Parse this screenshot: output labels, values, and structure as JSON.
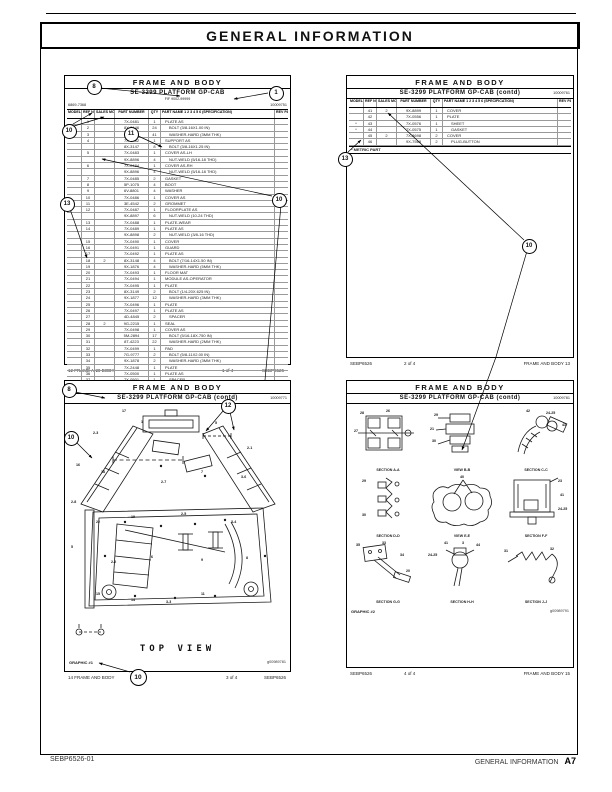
{
  "page": {
    "title": "GENERAL  INFORMATION",
    "footer_left": "SEBP6526-01",
    "footer_right": "GENERAL INFORMATION",
    "footer_page": "A7"
  },
  "callouts": {
    "n1": "1",
    "n8": "8",
    "n10": "10",
    "n11": "11",
    "n12": "12",
    "n13": "13"
  },
  "cols": [
    "MODEL",
    "REF NO",
    "SALES MOD",
    "PART NUMBER",
    "QTY",
    "PART NAME 1 2 3 4 5 6 (SPECIFICATION)",
    "REV PAGE"
  ],
  "panels": {
    "p1": {
      "header": "FRAME AND BODY",
      "subtitle": "SE-3299 PLATFORM GP-CAB",
      "subtitle2": "FIF 9002-99999",
      "code_left": "6869-7368",
      "code_right": "10009751",
      "rows": [
        {
          "r": "1",
          "p": "7X-0481",
          "q": "1",
          "n": "PLATE AS",
          "l": 1
        },
        {
          "r": "2",
          "p": "8X-3146",
          "q": "24",
          "n": "BOLT (3/8-16X1.00 IN)",
          "l": 2
        },
        {
          "r": "3",
          "p": "9X-1875",
          "q": "41",
          "n": "WASHER-HARD (3MM THK)",
          "l": 2
        },
        {
          "r": "4",
          "p": "7X-0482",
          "q": "1",
          "n": "SUPPORT AS",
          "l": 1
        },
        {
          "p": "8X-3147",
          "q": "8",
          "n": "BOLT (3/8-16X1.25 IN)",
          "l": 2
        },
        {
          "r": "5",
          "p": "7X-0483",
          "q": "1",
          "n": "COVER AS-LH",
          "l": 1
        },
        {
          "p": "9X-8896",
          "q": "4",
          "n": "NUT-WELD (5/16-18 THD)",
          "l": 2
        },
        {
          "r": "6",
          "p": "7X-0484",
          "q": "1",
          "n": "COVER AS-RH",
          "l": 1
        },
        {
          "p": "9X-8896",
          "q": "4",
          "n": "NUT-WELD (5/16-18 THD)",
          "l": 2
        },
        {
          "r": "7",
          "p": "7X-0485",
          "q": "2",
          "n": "GASKET",
          "l": 1
        },
        {
          "r": "8",
          "p": "5P-1075",
          "q": "4",
          "n": "BOOT",
          "l": 1
        },
        {
          "r": "9",
          "p": "6V-8801",
          "q": "4",
          "n": "WASHER",
          "l": 1
        },
        {
          "r": "10",
          "p": "7X-0486",
          "q": "1",
          "n": "COVER AS",
          "l": 1
        },
        {
          "r": "11",
          "p": "3E-4542",
          "q": "2",
          "n": "GROMMET",
          "l": 1
        },
        {
          "r": "12",
          "p": "7X-0487",
          "q": "1",
          "n": "FLOORPLATE AS",
          "l": 1
        },
        {
          "p": "9X-8897",
          "q": "6",
          "n": "NUT-WELD (10-24 THD)",
          "l": 2
        },
        {
          "r": "13",
          "p": "7X-0488",
          "q": "1",
          "n": "PLATE-WEAR",
          "l": 1
        },
        {
          "r": "14",
          "p": "7X-0489",
          "q": "1",
          "n": "PLATE AS",
          "l": 1
        },
        {
          "p": "9X-8898",
          "q": "2",
          "n": "NUT-WELD (3/8-16 THD)",
          "l": 2
        },
        {
          "r": "15",
          "p": "7X-0490",
          "q": "1",
          "n": "COVER",
          "l": 1
        },
        {
          "r": "16",
          "p": "7X-0491",
          "q": "1",
          "n": "GUARD",
          "l": 1
        },
        {
          "r": "17",
          "p": "7X-0492",
          "q": "1",
          "n": "PLATE AS",
          "l": 1
        },
        {
          "r": "18",
          "s": "2",
          "p": "8X-3148",
          "q": "4",
          "n": "BOLT (7/16-14X1.50 IN)",
          "l": 2
        },
        {
          "r": "19",
          "p": "9X-1876",
          "q": "4",
          "n": "WASHER-HARD (5MM THK)",
          "l": 2
        },
        {
          "r": "20",
          "p": "7X-0493",
          "q": "1",
          "n": "FLOOR MAT",
          "l": 1
        },
        {
          "r": "21",
          "p": "7X-0494",
          "q": "1",
          "n": "MODULE AS-OPERATOR",
          "l": 1
        },
        {
          "r": "22",
          "p": "7X-0495",
          "q": "1",
          "n": "PLATE",
          "l": 1
        },
        {
          "r": "23",
          "p": "8X-3149",
          "q": "2",
          "n": "BOLT (1/4-20X.625 IN)",
          "l": 2
        },
        {
          "r": "24",
          "p": "9X-1877",
          "q": "12",
          "n": "WASHER-HARD (3MM THK)",
          "l": 2
        },
        {
          "r": "25",
          "p": "7X-0496",
          "q": "1",
          "n": "PLATE",
          "l": 1
        },
        {
          "r": "26",
          "p": "7X-0497",
          "q": "1",
          "n": "PLATE AS",
          "l": 1
        },
        {
          "r": "27",
          "p": "4D-4845",
          "q": "2",
          "n": "SPACER",
          "l": 2
        },
        {
          "r": "28",
          "s": "2",
          "p": "9G-2215",
          "q": "1",
          "n": "SEAL",
          "l": 1
        },
        {
          "r": "29",
          "p": "7X-0498",
          "q": "1",
          "n": "COVER AS",
          "l": 1
        },
        {
          "r": "30",
          "p": "5M-2894",
          "q": "17",
          "n": "BOLT (5/16-18X.750 IN)",
          "l": 2
        },
        {
          "r": "31",
          "p": "8T-4223",
          "q": "22",
          "n": "WASHER-HARD (2MM THK)",
          "l": 2
        },
        {
          "r": "32",
          "p": "7X-0499",
          "q": "1",
          "n": "PAD",
          "l": 1
        },
        {
          "r": "33",
          "p": "7G-9777",
          "q": "2",
          "n": "BOLT (5/8-11X2.00 IN)",
          "l": 2
        },
        {
          "r": "34",
          "p": "9X-1878",
          "q": "2",
          "n": "WASHER-HARD (3MM THK)",
          "l": 2
        },
        {
          "r": "35",
          "p": "7X-2448",
          "q": "1",
          "n": "PLATE",
          "l": 1
        },
        {
          "r": "36",
          "p": "7X-0500",
          "q": "1",
          "n": "PLATE AS",
          "l": 1
        },
        {
          "r": "37",
          "p": "7X-0501",
          "q": "1",
          "n": "SPACER",
          "l": 2
        },
        {
          "r": "38",
          "p": "9X-2273",
          "q": "1",
          "n": "SUPPORT-GRAB RAIL",
          "l": 1
        },
        {
          "r": "39",
          "p": "2S-3260",
          "q": "1",
          "n": "DOME-BONNET HEAD",
          "l": 1
        },
        {
          "r": "40",
          "p": "7K-1181",
          "q": "2",
          "n": "STRAP-TIE",
          "l": 1
        }
      ],
      "footer_left": "12   FRAME AND BODY",
      "footer_center": "1 of 4",
      "footer_right": "SEBP6526"
    },
    "p2": {
      "header": "FRAME AND BODY",
      "subtitle": "SE-3299 PLATFORM GP-CAB (contd)",
      "code_right": "10009761",
      "rows": [
        {
          "r": "41",
          "s": "2",
          "p": "9X-8899",
          "q": "1",
          "n": "COVER",
          "l": 1
        },
        {
          "r": "42",
          "p": "7X-0556",
          "q": "1",
          "n": "PLATE",
          "l": 1
        },
        {
          "r": "43",
          "m": "*",
          "p": "7X-0576",
          "q": "1",
          "n": "SHEET",
          "l": 2
        },
        {
          "r": "44",
          "m": "*",
          "p": "7X-0575",
          "q": "1",
          "n": "GASKET",
          "l": 2
        },
        {
          "r": "45",
          "s": "2",
          "p": "7X-8698",
          "q": "2",
          "n": "COVER",
          "l": 1
        },
        {
          "r": "46",
          "p": "9X-7568",
          "q": "2",
          "n": "PLUG-BUTTON",
          "l": 2
        }
      ],
      "metric_note": "* METRIC PART",
      "footer_left": "SEBP6526",
      "footer_center": "2 of 4",
      "footer_right": "FRAME AND BODY   13"
    },
    "p3": {
      "header": "FRAME AND BODY",
      "subtitle": "SE-3299 PLATFORM GP-CAB (contd)",
      "code_right": "10009771",
      "view_label": "TOP VIEW",
      "graphic_label": "GRAPHIC #1",
      "image_code": "g00989781",
      "footer_left": "14   FRAME AND BODY",
      "footer_center": "3 of 4",
      "footer_right": "SEBP6526",
      "labels": [
        {
          "x": 57,
          "y": 4,
          "t": "17"
        },
        {
          "x": 28,
          "y": 26,
          "t": "2-3"
        },
        {
          "x": 76,
          "y": 15,
          "t": "1"
        },
        {
          "x": 150,
          "y": 16,
          "t": "5"
        },
        {
          "x": 182,
          "y": 41,
          "t": "2-1"
        },
        {
          "x": 11,
          "y": 58,
          "t": "16"
        },
        {
          "x": 36,
          "y": 65,
          "t": "18"
        },
        {
          "x": 96,
          "y": 75,
          "t": "2-7"
        },
        {
          "x": 136,
          "y": 65,
          "t": "7"
        },
        {
          "x": 176,
          "y": 70,
          "t": "3-6"
        },
        {
          "x": 6,
          "y": 95,
          "t": "2-8"
        },
        {
          "x": 31,
          "y": 115,
          "t": "22"
        },
        {
          "x": 66,
          "y": 110,
          "t": "19"
        },
        {
          "x": 116,
          "y": 107,
          "t": "2-5"
        },
        {
          "x": 166,
          "y": 115,
          "t": "3-4"
        },
        {
          "x": 6,
          "y": 140,
          "t": "5"
        },
        {
          "x": 46,
          "y": 155,
          "t": "2-2"
        },
        {
          "x": 86,
          "y": 150,
          "t": "6"
        },
        {
          "x": 136,
          "y": 153,
          "t": "9"
        },
        {
          "x": 181,
          "y": 151,
          "t": "8"
        },
        {
          "x": 31,
          "y": 187,
          "t": "15"
        },
        {
          "x": 66,
          "y": 193,
          "t": "14"
        },
        {
          "x": 101,
          "y": 195,
          "t": "3-3"
        },
        {
          "x": 136,
          "y": 187,
          "t": "11"
        }
      ]
    },
    "p4": {
      "header": "FRAME AND BODY",
      "subtitle": "SE-3299 PLATFORM GP-CAB (contd)",
      "code_right": "10009781",
      "graphic_label": "GRAPHIC #2",
      "image_code": "g00989791",
      "footer_left": "SEBP6526",
      "footer_center": "4 of 4",
      "footer_right": "FRAME AND BODY   15",
      "cells": [
        {
          "caption": "SECTION A-A",
          "labels": [
            {
              "x": 8,
              "y": 4,
              "t": "28"
            },
            {
              "x": 34,
              "y": 2,
              "t": "26"
            },
            {
              "x": 2,
              "y": 22,
              "t": "27"
            }
          ]
        },
        {
          "caption": "VIEW B-B",
          "labels": [
            {
              "x": 8,
              "y": 6,
              "t": "29"
            },
            {
              "x": 4,
              "y": 20,
              "t": "21"
            },
            {
              "x": 6,
              "y": 32,
              "t": "30"
            }
          ]
        },
        {
          "caption": "SECTION C-C",
          "labels": [
            {
              "x": 26,
              "y": 2,
              "t": "42"
            },
            {
              "x": 46,
              "y": 4,
              "t": "24-25"
            },
            {
              "x": 62,
              "y": 16,
              "t": "43"
            }
          ]
        },
        {
          "caption": "SECTION D-D",
          "labels": [
            {
              "x": 10,
              "y": 6,
              "t": "29"
            },
            {
              "x": 10,
              "y": 40,
              "t": "30"
            }
          ]
        },
        {
          "caption": "VIEW E-E",
          "labels": [
            {
              "x": 34,
              "y": 2,
              "t": "40"
            }
          ]
        },
        {
          "caption": "SECTION F-F",
          "labels": [
            {
              "x": 58,
              "y": 6,
              "t": "23"
            },
            {
              "x": 60,
              "y": 20,
              "t": "41"
            },
            {
              "x": 58,
              "y": 34,
              "t": "24-25"
            }
          ]
        },
        {
          "caption": "SECTION G-G",
          "labels": [
            {
              "x": 4,
              "y": 4,
              "t": "35"
            },
            {
              "x": 30,
              "y": 2,
              "t": "33"
            },
            {
              "x": 48,
              "y": 14,
              "t": "34"
            },
            {
              "x": 54,
              "y": 30,
              "t": "20"
            }
          ]
        },
        {
          "caption": "SECTION H-H",
          "labels": [
            {
              "x": 18,
              "y": 2,
              "t": "41"
            },
            {
              "x": 36,
              "y": 2,
              "t": "3"
            },
            {
              "x": 50,
              "y": 4,
              "t": "44"
            },
            {
              "x": 2,
              "y": 14,
              "t": "24-25"
            }
          ]
        },
        {
          "caption": "SECTION J-J",
          "labels": [
            {
              "x": 4,
              "y": 10,
              "t": "31"
            },
            {
              "x": 50,
              "y": 8,
              "t": "32"
            }
          ]
        }
      ]
    }
  }
}
